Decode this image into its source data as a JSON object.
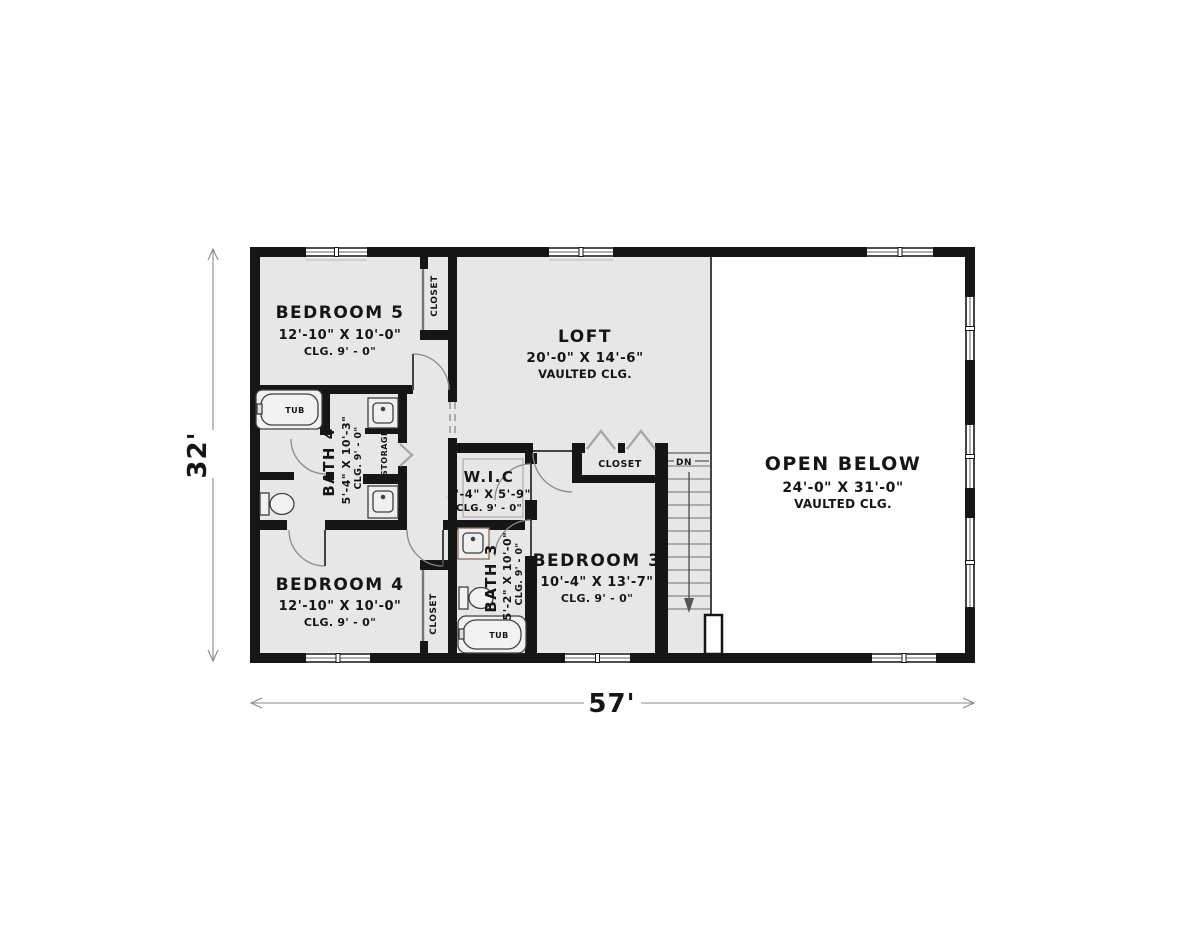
{
  "plan": {
    "title": "second-floor-plan",
    "rooms": [
      {
        "name": "BEDROOM 5",
        "size": "12'-10\" X 10'-0\"",
        "ceiling": "CLG. 9' - 0\""
      },
      {
        "name": "LOFT",
        "size": "20'-0\" X 14'-6\"",
        "ceiling": "VAULTED CLG."
      },
      {
        "name": "OPEN BELOW",
        "size": "24'-0\" X 31'-0\"",
        "ceiling": "VAULTED CLG."
      },
      {
        "name": "BATH 4",
        "size": "5'-4\" X 10'-3\"",
        "ceiling": "CLG. 9' - 0\""
      },
      {
        "name": "W.I.C",
        "size": "5'-4\" X 5'-9\"",
        "ceiling": "CLG. 9' - 0\""
      },
      {
        "name": "BEDROOM 4",
        "size": "12'-10\" X 10'-0\"",
        "ceiling": "CLG. 9' - 0\""
      },
      {
        "name": "BATH 3",
        "size": "5'-2\" X 10'-0\"",
        "ceiling": "CLG. 9' - 0\""
      },
      {
        "name": "BEDROOM 3",
        "size": "10'-4\" X 13'-7\"",
        "ceiling": "CLG. 9' - 0\""
      }
    ],
    "labels": {
      "closet": "CLOSET",
      "storage": "STORAGE",
      "tub": "TUB",
      "down": "DN"
    },
    "dimensions": {
      "overall_width": "57'",
      "overall_height": "32'"
    },
    "colors": {
      "wall": "#161616",
      "floor": "#e7e7e7",
      "open_area": "#ffffff",
      "thin_line": "#8a8a8a"
    }
  }
}
